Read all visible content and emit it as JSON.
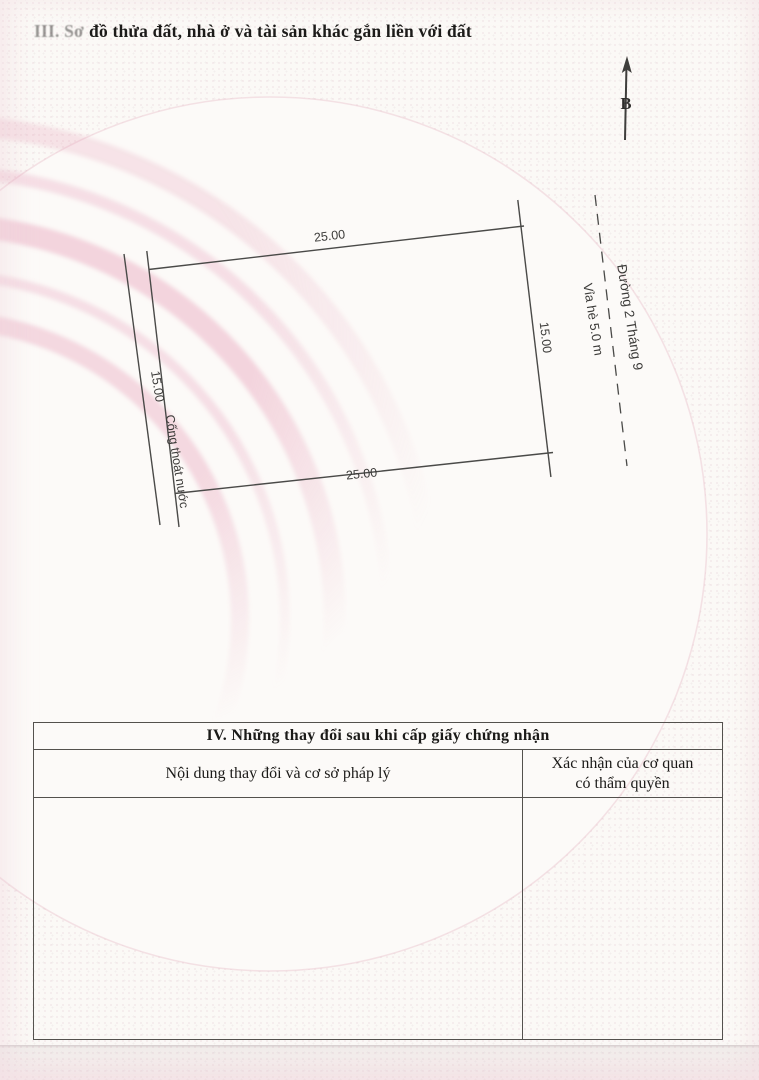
{
  "document": {
    "section3_title_faded": "III. Sơ",
    "section3_title_rest": "đồ thửa đất, nhà ở và tài sản khác gắn liền với đất"
  },
  "compass": {
    "north_label": "B"
  },
  "diagram": {
    "parcel": {
      "top_dim": "25.00",
      "bottom_dim": "25.00",
      "left_dim": "15.00",
      "right_dim": "15.00"
    },
    "labels": {
      "drainage": "Cống thoát nước",
      "sidewalk": "Vỉa hè 5.0 m",
      "street": "Đường 2 Tháng 9"
    }
  },
  "section4_table": {
    "title": "IV. Những thay đổi sau khi cấp giấy chứng nhận",
    "columns": [
      {
        "header": "Nội dung thay đổi và cơ sở pháp lý"
      },
      {
        "header_line1": "Xác nhận của cơ quan",
        "header_line2": "có thẩm quyền"
      }
    ]
  },
  "colors": {
    "ink": "#1d1c1a",
    "diagram_line": "#4a4a48",
    "watermark_pink": "#e9a8bc",
    "paper": "#fbf9f6"
  }
}
